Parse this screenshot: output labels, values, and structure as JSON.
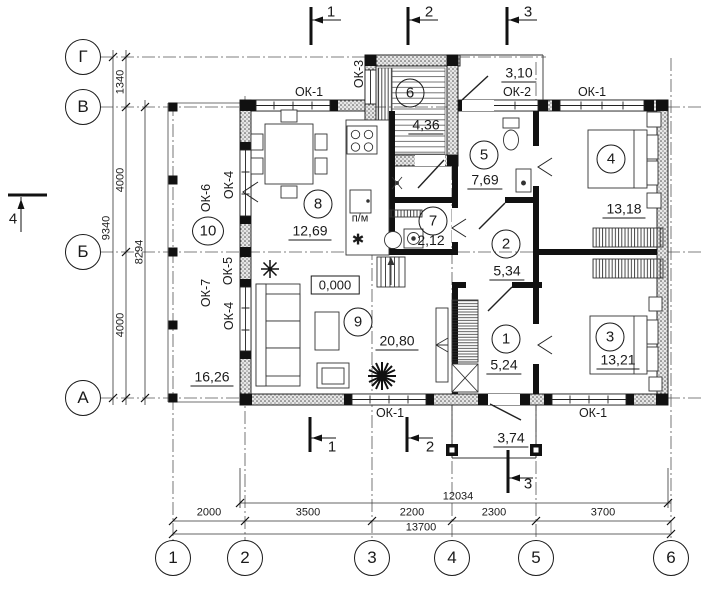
{
  "axes": {
    "rows": [
      "Г",
      "В",
      "Б",
      "А"
    ],
    "cols": [
      "1",
      "2",
      "3",
      "4",
      "5",
      "6"
    ]
  },
  "dims": {
    "bottom": {
      "segments": [
        "2000",
        "3500",
        "2200",
        "2300",
        "3700"
      ],
      "inner_total": "12034",
      "total": "13700"
    },
    "left": {
      "segments": [
        "1340",
        "4000",
        "4000"
      ],
      "total": "9340",
      "inner_total": "8294"
    },
    "porch_top": "3,10",
    "porch_bottom": "3,74"
  },
  "rooms": [
    {
      "number": "1",
      "area": "5,24"
    },
    {
      "number": "2",
      "area": "5,34"
    },
    {
      "number": "3",
      "area": "13,21"
    },
    {
      "number": "4",
      "area": "13,18"
    },
    {
      "number": "5",
      "area": "7,69"
    },
    {
      "number": "6",
      "area": "4,36"
    },
    {
      "number": "7",
      "area": "2,12"
    },
    {
      "number": "8",
      "area": "12,69"
    },
    {
      "number": "9",
      "area": "20,80"
    },
    {
      "number": "10",
      "area": "16,26"
    }
  ],
  "windows": {
    "ok1": "ОК-1",
    "ok2": "ОК-2",
    "ok3": "ОК-3",
    "ok4": "ОК-4",
    "ok5": "ОК-5",
    "ok6": "ОК-6",
    "ok7": "ОК-7"
  },
  "sections": {
    "s1": "1",
    "s2": "2",
    "s3": "3",
    "s4": "4"
  },
  "marks": {
    "level": "0,000",
    "pm": "п/м",
    "sink": "✱"
  }
}
